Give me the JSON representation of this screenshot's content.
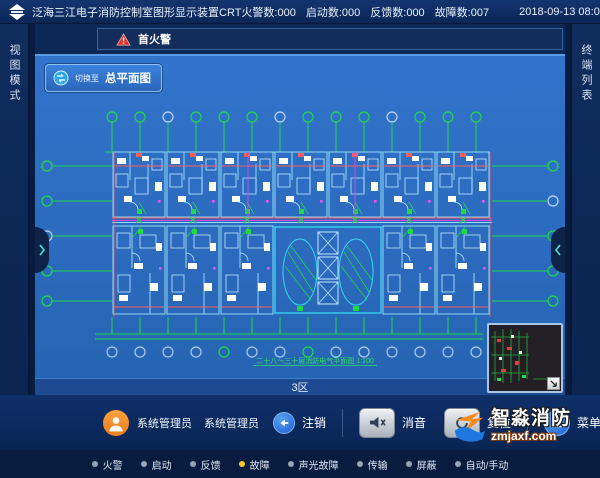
{
  "window": {
    "title": "泛海三江电子消防控制室图形显示装置CRT"
  },
  "header": {
    "counters": [
      "火警数:000",
      "启动数:000",
      "反馈数:000",
      "故障数:007"
    ],
    "datetime": "2018-09-13 08:06:54"
  },
  "sidebar_left": {
    "label": "视图模式"
  },
  "sidebar_right": {
    "label": "终端列表"
  },
  "alarm_bar": {
    "label": "首火警"
  },
  "map": {
    "switch_prefix": "切换至",
    "switch_label": "总平面图",
    "zone_label": "3区",
    "plan_caption": "二十八～三十层消防电气平面图 1:100"
  },
  "footer": {
    "user_role": "系统管理员",
    "user_name": "系统管理员",
    "logout_label": "注销",
    "mute_label": "消音",
    "reset_label": "复位",
    "menu_label": "菜单"
  },
  "legend": {
    "items": [
      {
        "label": "火警",
        "color": "#97a3b6"
      },
      {
        "label": "启动",
        "color": "#97a3b6"
      },
      {
        "label": "反馈",
        "color": "#97a3b6"
      },
      {
        "label": "故障",
        "color": "#ffc61e"
      },
      {
        "label": "声光故障",
        "color": "#97a3b6"
      },
      {
        "label": "传输",
        "color": "#97a3b6"
      },
      {
        "label": "屏蔽",
        "color": "#97a3b6"
      },
      {
        "label": "自动/手动",
        "color": "#97a3b6"
      }
    ]
  },
  "watermark": {
    "title": "智淼消防",
    "url": "zmjaxf.com"
  },
  "colors": {
    "map_blue": "#2c6cc0",
    "alarm_red": "#e3342f",
    "fault_yellow": "#ffc61e"
  }
}
